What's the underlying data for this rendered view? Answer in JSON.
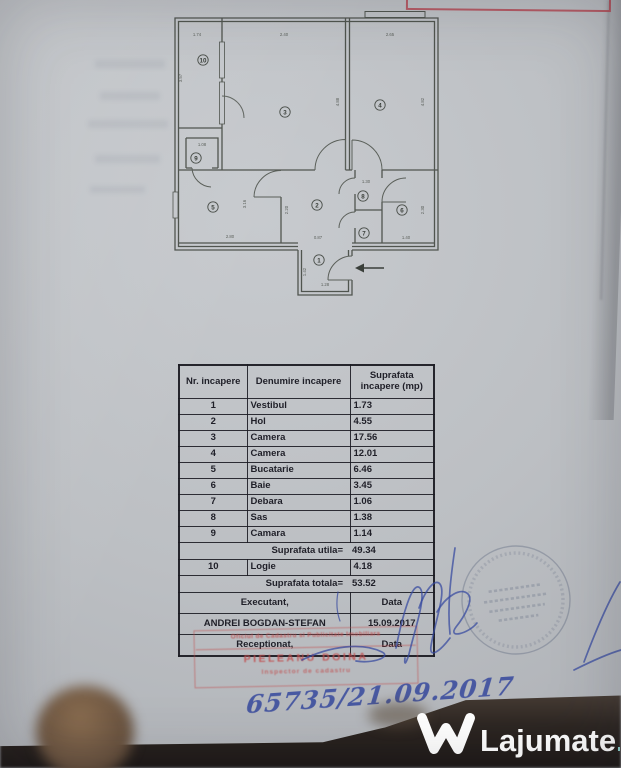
{
  "colors": {
    "paper": "#bfc2c6",
    "plan_line": "#50554f",
    "red_stamp": "#c24e4e",
    "blue_ink": "#31449c",
    "watermark_white": "#ffffff",
    "watermark_teal": "#8ad2cf",
    "photo_band": "#2d2622"
  },
  "watermark": {
    "brand": "Lajumate",
    "tld": ".ro"
  },
  "annotations": {
    "handwritten_number": "65735/21.09.2017"
  },
  "red_stamp": {
    "line1": "Oficiul de Cadastru si Publicitate Imobiliara",
    "name": "PIELEANU DOINA",
    "line2": "Inspector de cadastru"
  },
  "floor_plan": {
    "rooms": [
      {
        "n": "1",
        "x": 153,
        "y": 254
      },
      {
        "n": "2",
        "x": 151,
        "y": 199
      },
      {
        "n": "3",
        "x": 119,
        "y": 106
      },
      {
        "n": "4",
        "x": 214,
        "y": 99
      },
      {
        "n": "5",
        "x": 47,
        "y": 201
      },
      {
        "n": "6",
        "x": 236,
        "y": 204
      },
      {
        "n": "7",
        "x": 198,
        "y": 227
      },
      {
        "n": "8",
        "x": 197,
        "y": 190
      },
      {
        "n": "9",
        "x": 30,
        "y": 152
      },
      {
        "n": "10",
        "x": 37,
        "y": 54
      }
    ],
    "dims": [
      {
        "t": "1.74",
        "x": 31,
        "y": 30,
        "r": 0
      },
      {
        "t": "2.40",
        "x": 118,
        "y": 30,
        "r": 0
      },
      {
        "t": "2.65",
        "x": 224,
        "y": 30,
        "r": 0
      },
      {
        "t": "3.57",
        "x": 16,
        "y": 72,
        "r": -90
      },
      {
        "t": "4.88",
        "x": 173,
        "y": 96,
        "r": -90
      },
      {
        "t": "4.82",
        "x": 258,
        "y": 96,
        "r": -90
      },
      {
        "t": "1.08",
        "x": 36,
        "y": 140,
        "r": 0
      },
      {
        "t": "3.16",
        "x": 80,
        "y": 198,
        "r": -90
      },
      {
        "t": "2.80",
        "x": 64,
        "y": 232,
        "r": 0
      },
      {
        "t": "2.20",
        "x": 122,
        "y": 204,
        "r": -90
      },
      {
        "t": "0.87",
        "x": 152,
        "y": 233,
        "r": 0
      },
      {
        "t": "1.30",
        "x": 200,
        "y": 177,
        "r": 0
      },
      {
        "t": "1.40",
        "x": 240,
        "y": 233,
        "r": 0
      },
      {
        "t": "2.30",
        "x": 258,
        "y": 204,
        "r": -90
      },
      {
        "t": "1.42",
        "x": 140,
        "y": 266,
        "r": -90
      },
      {
        "t": "1.28",
        "x": 159,
        "y": 280,
        "r": 0
      }
    ]
  },
  "table": {
    "headers": [
      "Nr. incapere",
      "Denumire incapere",
      "Suprafata incapere (mp)"
    ],
    "rows": [
      {
        "type": "data",
        "cells": [
          "1",
          "Vestibul",
          "1.73"
        ]
      },
      {
        "type": "data",
        "cells": [
          "2",
          "Hol",
          "4.55"
        ]
      },
      {
        "type": "data",
        "cells": [
          "3",
          "Camera",
          "17.56"
        ]
      },
      {
        "type": "data",
        "cells": [
          "4",
          "Camera",
          "12.01"
        ]
      },
      {
        "type": "data",
        "cells": [
          "5",
          "Bucatarie",
          "6.46"
        ]
      },
      {
        "type": "data",
        "cells": [
          "6",
          "Baie",
          "3.45"
        ]
      },
      {
        "type": "data",
        "cells": [
          "7",
          "Debara",
          "1.06"
        ]
      },
      {
        "type": "data",
        "cells": [
          "8",
          "Sas",
          "1.38"
        ]
      },
      {
        "type": "data",
        "cells": [
          "9",
          "Camara",
          "1.14"
        ]
      },
      {
        "type": "total",
        "label": "Suprafata utila=",
        "value": "49.34"
      },
      {
        "type": "data",
        "cells": [
          "10",
          "Logie",
          "4.18"
        ]
      },
      {
        "type": "total",
        "label": "Suprafata totala=",
        "value": "53.52"
      },
      {
        "type": "split",
        "left": "Executant,",
        "right": "Data"
      },
      {
        "type": "split",
        "left": "ANDREI BOGDAN-STEFAN",
        "right": "15.09.2017"
      },
      {
        "type": "split",
        "left": "Receptionat,",
        "right": "Data"
      }
    ]
  }
}
